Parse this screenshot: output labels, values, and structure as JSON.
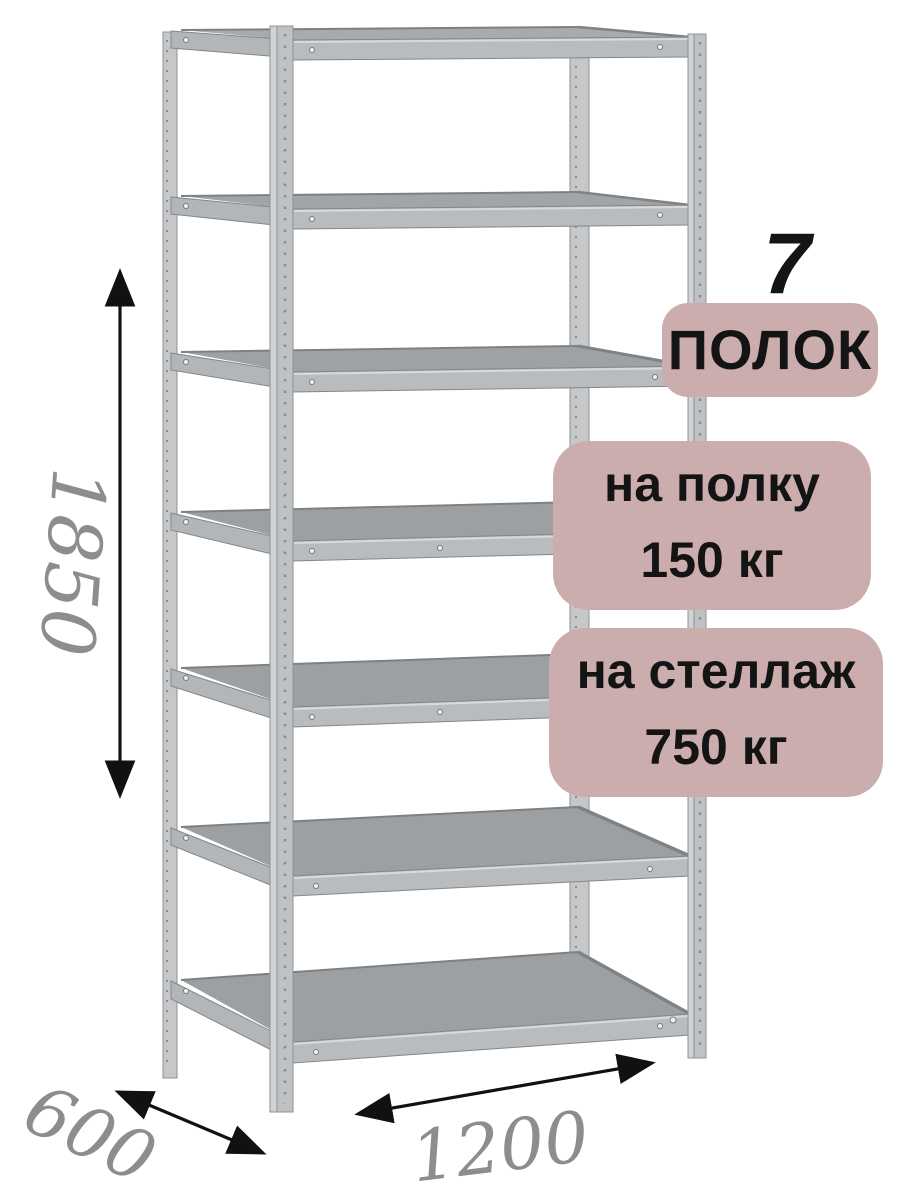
{
  "callouts": {
    "shelf_count": {
      "number": "7",
      "label": "ПОЛОК"
    },
    "per_shelf": {
      "line1": "на полку",
      "line2": "150 кг"
    },
    "per_rack": {
      "line1": "на стеллаж",
      "line2": "750 кг"
    }
  },
  "dimensions": {
    "height": "1850",
    "depth": "600",
    "width": "1200"
  },
  "illustration": {
    "subject": "metal-shelving-rack",
    "shelf_count": 7
  },
  "theme": {
    "badge-bg": "#cbadad",
    "badge-text": "#141414",
    "dim-text": "#8d8d8d",
    "arrow": "#111111",
    "post-gray": "#c5c7c9",
    "beam-gray": "#b9bcbe",
    "surface-gray": "#9da0a3"
  }
}
